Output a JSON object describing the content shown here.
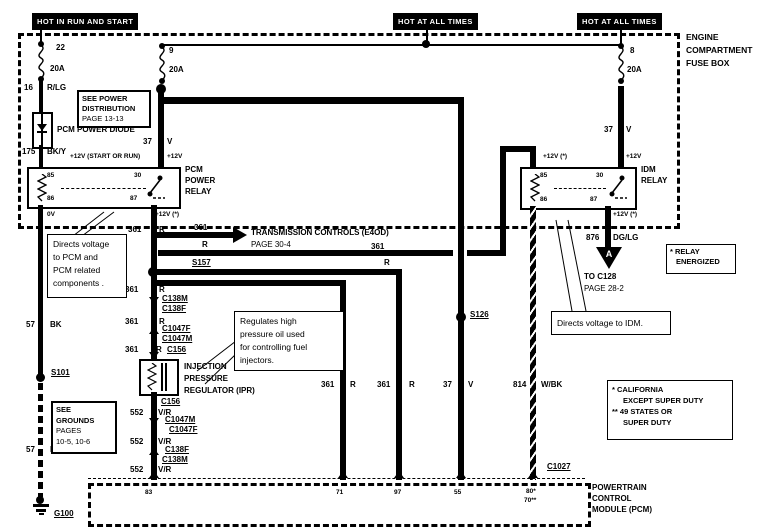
{
  "colors": {
    "ink": "#000000",
    "paper": "#ffffff"
  },
  "power_labels": {
    "run_start": "HOT IN RUN AND START",
    "all_times_1": "HOT AT ALL TIMES",
    "all_times_2": "HOT AT ALL TIMES"
  },
  "fuse_box": {
    "name_lines": [
      "ENGINE",
      "COMPARTMENT",
      "FUSE BOX"
    ],
    "fuse_22": {
      "id": "22",
      "rating": "20A"
    },
    "fuse_9": {
      "id": "9",
      "rating": "20A"
    },
    "fuse_8": {
      "id": "8",
      "rating": "20A"
    }
  },
  "see_power_box": {
    "lines": [
      "SEE POWER",
      "DISTRIBUTION",
      "PAGE 13-13"
    ]
  },
  "diode": {
    "label": "PCM POWER DIODE"
  },
  "wires": {
    "w16": {
      "circuit": "16",
      "color": "R/LG"
    },
    "w175": {
      "circuit": "175",
      "color": "BK/Y"
    },
    "w37_left": {
      "circuit": "37",
      "color": "V"
    },
    "w37_right": {
      "circuit": "37",
      "color": "V"
    },
    "w37_mid": {
      "circuit": "37",
      "color": "V"
    },
    "w361_a": {
      "circuit": "361",
      "color": "R"
    },
    "w361_arrow": {
      "circuit": "361",
      "color": "R"
    },
    "w361_idm": {
      "circuit": "361",
      "color": "R"
    },
    "w361_b": {
      "circuit": "361",
      "color": "R"
    },
    "w361_c": {
      "circuit": "361",
      "color": "R"
    },
    "w361_d": {
      "circuit": "361",
      "color": "R"
    },
    "w361_pin71": {
      "circuit": "361",
      "color": "R"
    },
    "w361_pin97": {
      "circuit": "361",
      "color": "R"
    },
    "w552_a": {
      "circuit": "552",
      "color": "V/R"
    },
    "w552_b": {
      "circuit": "552",
      "color": "V/R"
    },
    "w552_c": {
      "circuit": "552",
      "color": "V/R"
    },
    "w57_a": {
      "circuit": "57",
      "color": "BK"
    },
    "w57_b": {
      "circuit": "57",
      "color": "BK"
    },
    "w814": {
      "circuit": "814",
      "color": "W/BK"
    },
    "w876": {
      "circuit": "876",
      "color": "DG/LG"
    }
  },
  "pcm_relay": {
    "name_lines": [
      "PCM",
      "POWER",
      "RELAY"
    ],
    "pins": {
      "p85": "85",
      "p30": "30",
      "p86": "86",
      "p87": "87"
    },
    "volt_top_left": "+12V (START OR RUN)",
    "volt_top_right": "+12V",
    "volt_bottom_left": "0V",
    "volt_bottom_right": "+12V (*)"
  },
  "idm_relay": {
    "name_lines": [
      "IDM",
      "RELAY"
    ],
    "pins": {
      "p85": "85",
      "p30": "30",
      "p86": "86",
      "p87": "87"
    },
    "volt_top_left": "+12V (*)",
    "volt_top_right": "+12V",
    "volt_bottom_right": "+12V (*)"
  },
  "transmission": {
    "line1": "TRANSMISSION CONTROLS (E4OD)",
    "line2": "PAGE 30-4"
  },
  "splices": {
    "s157": "S157",
    "s126": "S126",
    "s101": "S101"
  },
  "grounds": {
    "g100": "G100"
  },
  "connectors": {
    "c138m_1": "C138M",
    "c138f_1": "C138F",
    "c1047f_1": "C1047F",
    "c1047m_1": "C1047M",
    "c156_1": "C156",
    "c156_2": "C156",
    "c1047m_2": "C1047M",
    "c1047f_2": "C1047F",
    "c138f_2": "C138F",
    "c138m_2": "C138M",
    "c1027": "C1027"
  },
  "ipr": {
    "name_lines": [
      "INJECTION",
      "PRESSURE",
      "REGULATOR (IPR)"
    ]
  },
  "see_grounds_box": {
    "lines": [
      "SEE",
      "GROUNDS",
      "PAGES",
      "10-5, 10-6"
    ]
  },
  "callouts": {
    "pcm": {
      "lines": [
        "Directs voltage",
        "to PCM and",
        "PCM related",
        "components ."
      ]
    },
    "idm": {
      "text": "Directs  voltage to IDM."
    },
    "ipr": {
      "lines": [
        "Regulates high",
        "pressure oil used",
        "for controlling fuel",
        "injectors."
      ]
    }
  },
  "to_c128": {
    "connector_letter": "A",
    "line1": "TO C128",
    "line2": "PAGE 28-2"
  },
  "relay_energized_box": {
    "lines": [
      "* RELAY",
      "ENERGIZED"
    ]
  },
  "notes_box": {
    "lines": [
      "*  CALIFORNIA",
      "EXCEPT SUPER DUTY",
      "** 49 STATES OR",
      "SUPER DUTY"
    ]
  },
  "pcm_module": {
    "name_lines": [
      "POWERTRAIN",
      "CONTROL",
      "MODULE (PCM)"
    ],
    "pins": {
      "p83": "83",
      "p71": "71",
      "p97": "97",
      "p55": "55",
      "p80": "80*",
      "p70": "70**"
    }
  }
}
